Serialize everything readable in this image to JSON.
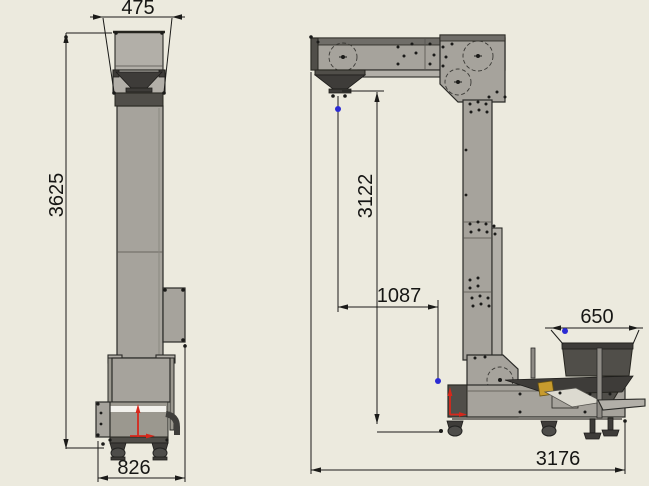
{
  "dimensions": {
    "front": {
      "top_width": "475",
      "overall_height": "3625",
      "base_depth": "826"
    },
    "side": {
      "discharge_height": "3122",
      "horizontal_offset": "1087",
      "hopper_width": "650",
      "overall_length": "3176"
    }
  },
  "colors": {
    "background": "#ECEADE",
    "machine_gray": "#A6A39C",
    "machine_dark": "#504E49",
    "outline": "#2A2A27",
    "dimension_line": "#1B1B19",
    "marker_red": "#D6281C",
    "marker_blue": "#2B2BD4",
    "part_yellow": "#C79B2E"
  }
}
